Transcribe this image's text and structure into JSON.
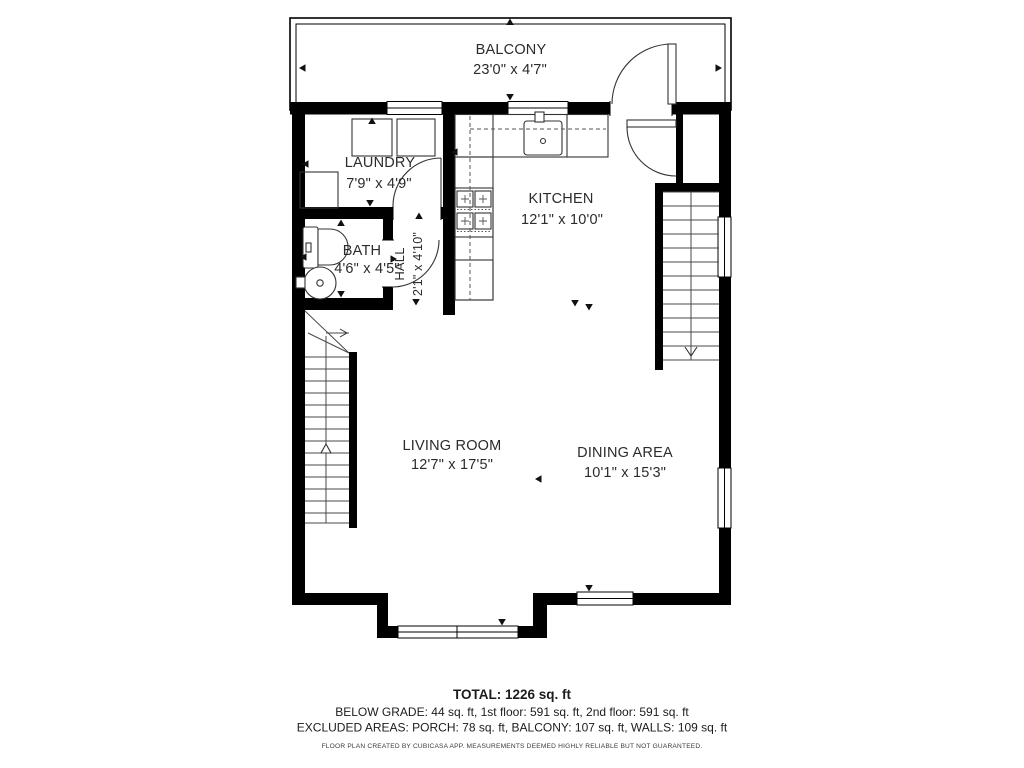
{
  "rooms": {
    "balcony": {
      "name": "BALCONY",
      "dims": "23'0\" x 4'7\""
    },
    "laundry": {
      "name": "LAUNDRY",
      "dims": "7'9\" x 4'9\""
    },
    "kitchen": {
      "name": "KITCHEN",
      "dims": "12'1\" x 10'0\""
    },
    "bath": {
      "name": "BATH",
      "dims": "4'6\" x 4'5\""
    },
    "hall": {
      "name": "HALL",
      "dims": "2'1\" x 4'10\""
    },
    "living_room": {
      "name": "LIVING ROOM",
      "dims": "12'7\" x 17'5\""
    },
    "dining_area": {
      "name": "DINING AREA",
      "dims": "10'1\" x 15'3\""
    }
  },
  "summary": {
    "total": "TOTAL: 1226 sq. ft",
    "floors": "BELOW GRADE: 44 sq. ft, 1st floor: 591 sq. ft, 2nd floor: 591 sq. ft",
    "excluded": "EXCLUDED AREAS: PORCH: 78 sq. ft, BALCONY: 107 sq. ft, WALLS: 109 sq. ft",
    "disclaimer": "FLOOR PLAN CREATED BY CUBICASA APP. MEASUREMENTS DEEMED HIGHLY RELIABLE BUT NOT GUARANTEED."
  },
  "colors": {
    "walls": "#000000",
    "text": "#2b2b2b",
    "background": "#ffffff"
  }
}
